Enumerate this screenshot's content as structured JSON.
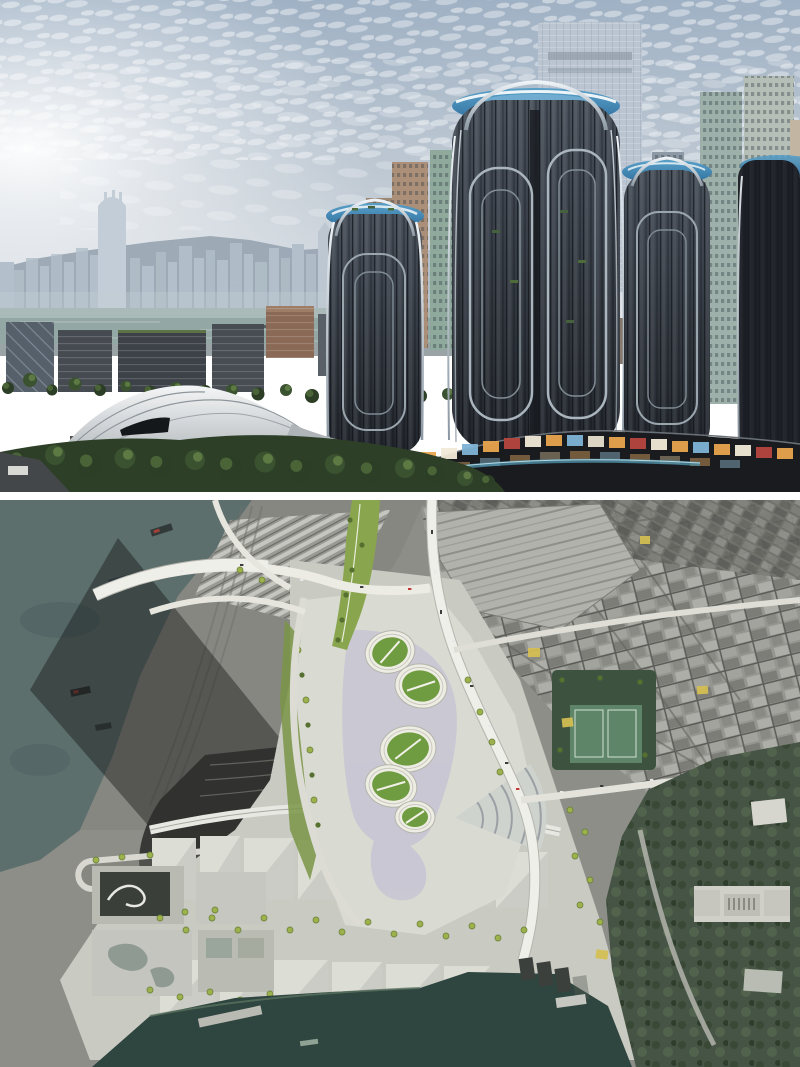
{
  "figure": {
    "title": "Harbourfront towers rendering and aerial masterplan composite",
    "panels": {
      "rendering": {
        "description": "Photorealistic rendering of curved glass towers with chrome ribs and blue rooftop crowns above an illuminated retail podium, beside a wave-roofed station surrounded by trees, with Victoria Harbour, the Hong Kong Island skyline and sun glare behind",
        "elements": [
          "sun-glare sky with altocumulus clouds",
          "mountain ridge",
          "island skyline with tall tapering tower",
          "harbour water",
          "waterfront office blocks",
          "wave-roof station",
          "foreground tree canopy",
          "ICC supertall in haze",
          "residential towers",
          "three curved glass towers",
          "blue glass crowns",
          "retail podium with lit storefronts"
        ]
      },
      "aerial": {
        "description": "Aerial satellite composite: grey urban fabric and rail yard, harbour water to the west and south, a coloured masterplan with oval green tower roofs, linear park, white roads with yellow junction boxes, warehouse blocks with street trees, and a wooded hill with a colonnaded heritage building at lower right",
        "elements": [
          "west harbour water with barges",
          "rail yard and sheds",
          "tower shadow",
          "station throat tracks",
          "hairpin loop road",
          "oval green tower roofs",
          "fan-shaped platform roof",
          "linear park",
          "white road network",
          "yellow junction markings",
          "warehouse block rows with trees",
          "south harbour water with pier",
          "dense eastern city grid",
          "parking lot",
          "sports courts park",
          "wooded hill",
          "heritage building"
        ]
      }
    }
  },
  "palette": {
    "sky_top": "#9fb1c4",
    "sky_horizon": "#e2e6ea",
    "sun_glare": "#ffffff",
    "mountain": "#9aa7b3",
    "skyline": "#b3c0cb",
    "harbour": "#93a7a5",
    "foliage": "#2e3f28",
    "station_roof": "#f4f5f6",
    "icc": "#bac5d1",
    "tower_glass_top": "#474f59",
    "tower_glass_bottom": "#21252c",
    "chrome": "#eef3f7",
    "crown_top": "#59a0c8",
    "crown_bottom": "#2e6e9e",
    "podium": "#191b1f",
    "shop_warm": "#e8a54e",
    "divider": "#ffffff",
    "aerial_base": "#8e8e89",
    "aerial_water": "#5c6f6d",
    "south_water": "#2f453f",
    "plan_ground": "#d9dad2",
    "plan_road": "#efefe9",
    "park_green": "#89a54d",
    "oval_green": "#6f9c40",
    "podium_lavender": "#c6c4d4",
    "warehouse": "#cbccc5",
    "forest": "#465445",
    "city_block": "#969691",
    "junction_yellow": "#d6c052"
  }
}
